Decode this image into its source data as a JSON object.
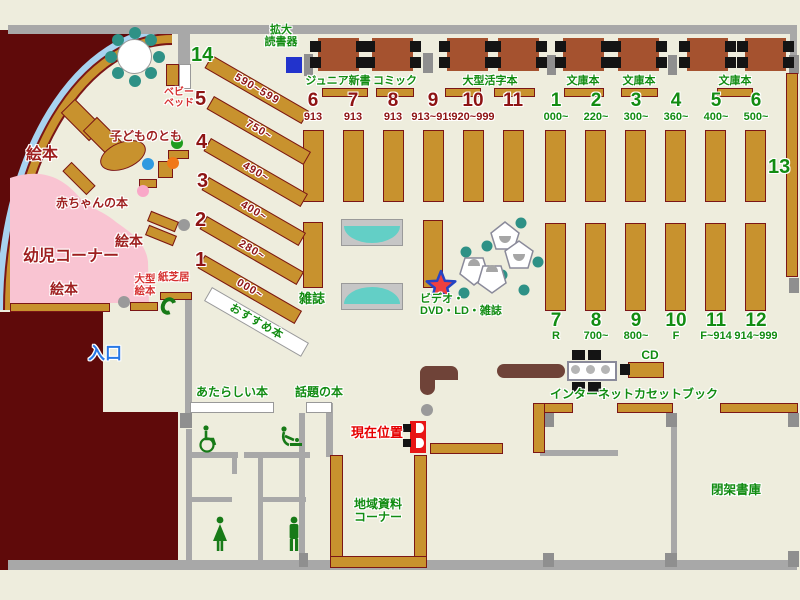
{
  "labels": {
    "kakudai": "拡大\n読書器",
    "junior_shinsho": "ジュニア新書",
    "comic": "コミック",
    "ogata_katsuji": "大型活字本",
    "bunko_1": "文庫本",
    "bunko_2": "文庫本",
    "bunko_3": "文庫本",
    "baby_bed": "ベビー\nベッド",
    "ehon_top": "絵本",
    "ehon_mid": "絵本",
    "ehon_low": "絵本",
    "kodomo_no_tomo": "子どものとも",
    "akachan_no_hon": "赤ちゃんの本",
    "yoji_corner": "幼児コーナー",
    "ogata_ehon": "大型\n絵本",
    "kamishibai": "紙芝居",
    "iriguchi": "入口",
    "zasshi": "雑誌",
    "video": "ビデオ・\nDVD・LD・雑誌",
    "osusume": "おすすめ本",
    "atarashii": "あたらしい本",
    "wadai": "話題の本",
    "genzai_ichi": "現在位置",
    "internet": "インターネット",
    "cd": "CD",
    "cassette": "カセットブック",
    "chiiki": "地域資料\nコーナー",
    "heika": "閉架書庫",
    "s13": "13"
  },
  "diagonal_stacks": [
    {
      "num": "14",
      "range": "590~599"
    },
    {
      "num": "5",
      "range": "750~"
    },
    {
      "num": "4",
      "range": "490~"
    },
    {
      "num": "3",
      "range": "400~"
    },
    {
      "num": "2",
      "range": "280~"
    },
    {
      "num": "1",
      "range": "000~"
    }
  ],
  "stacks": {
    "red_top": [
      {
        "num": "6",
        "range": "913"
      },
      {
        "num": "7",
        "range": "913"
      },
      {
        "num": "8",
        "range": "913"
      },
      {
        "num": "9",
        "range": "913~919"
      },
      {
        "num": "10",
        "range": "920~999"
      },
      {
        "num": "11",
        "range": ""
      }
    ],
    "green_top": [
      {
        "num": "1",
        "range": "000~"
      },
      {
        "num": "2",
        "range": "220~"
      },
      {
        "num": "3",
        "range": "300~"
      },
      {
        "num": "4",
        "range": "360~"
      },
      {
        "num": "5",
        "range": "400~"
      },
      {
        "num": "6",
        "range": "500~"
      }
    ],
    "green_bottom": [
      {
        "num": "7",
        "range": "R"
      },
      {
        "num": "8",
        "range": "700~"
      },
      {
        "num": "9",
        "range": "800~"
      },
      {
        "num": "10",
        "range": "F"
      },
      {
        "num": "11",
        "range": "F~914"
      },
      {
        "num": "12",
        "range": "914~999"
      }
    ]
  },
  "colors": {
    "floor": "#eeeddd",
    "exterior": "#5f0a0a",
    "shelf": "#c8922e",
    "shelf_border": "#7b1616",
    "wall": "#a8a8a8",
    "table": "#a5522f",
    "teal": "#2e9186",
    "bench_teal": "#63cfc6",
    "pink": "#f9c4d2",
    "window_blue": "#a8d3f0",
    "green_text": "#128c12",
    "darkred_text": "#9e1f1f",
    "counter": "#6f4338",
    "entrance_blue": "#2878e6",
    "marker_red": "#e81515",
    "device_blue": "#2233cc"
  }
}
